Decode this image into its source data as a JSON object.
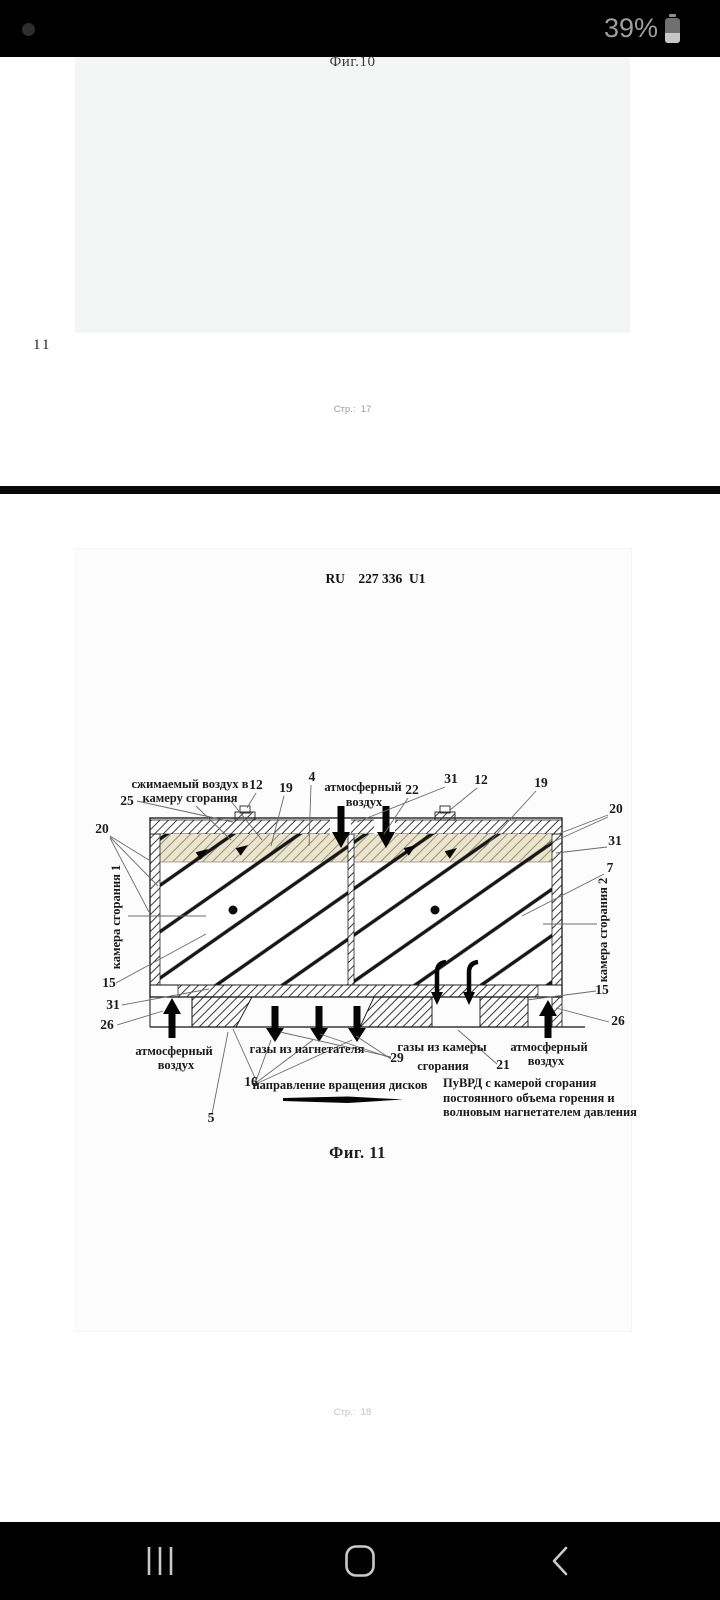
{
  "status_bar": {
    "battery_percent": "39%",
    "icons": [
      "battery"
    ]
  },
  "viewer": {
    "page17": {
      "fig_caption": "Фиг.10",
      "margin_page_number": "11",
      "footer": "Стр.:  17"
    },
    "page18": {
      "header": "RU    227 336  U1",
      "fig_caption": "Фиг. 11",
      "footer": "Стр.:  18",
      "diagram": {
        "labels": {
          "compressed_air_line1": "сжимаемый воздух в",
          "compressed_air_line2": "камеру сгорания",
          "atm_air_top_line1": "атмосферный",
          "atm_air_top_line2": "воздух",
          "chamber1": "камера сгорания 1",
          "chamber2": "камера сгорания 2",
          "atm_air_bl_line1": "атмосферный",
          "atm_air_bl_line2": "воздух",
          "atm_air_br_line1": "атмосферный",
          "atm_air_br_line2": "воздух",
          "gases_supercharger": "газы из нагнетателя",
          "gases_chamber_line1": "газы из камеры",
          "gases_chamber_line2": "сгорания",
          "rotation_direction": "направление вращения дисков",
          "caption_line1": "ПуВРД с камерой сгорания",
          "caption_line2": "постоянного объема горения и",
          "caption_line3": "волновым нагнетателем давления"
        },
        "numbers": {
          "n25": "25",
          "n12a": "12",
          "n19a": "19",
          "n4": "4",
          "n22": "22",
          "n31a": "31",
          "n12b": "12",
          "n19b": "19",
          "n20l": "20",
          "n20r": "20",
          "n31r": "31",
          "n7": "7",
          "n15l": "15",
          "n31bl": "31",
          "n26l": "26",
          "n16": "16",
          "n29": "29",
          "n21": "21",
          "n26r": "26",
          "n15r": "15",
          "n5": "5"
        }
      }
    }
  },
  "nav_bar": {
    "icons": [
      "recents",
      "home",
      "back"
    ]
  },
  "colors": {
    "page_divider": "#070707",
    "cream_fill": "#ece4cb",
    "status_text": "#9e9e9e"
  }
}
